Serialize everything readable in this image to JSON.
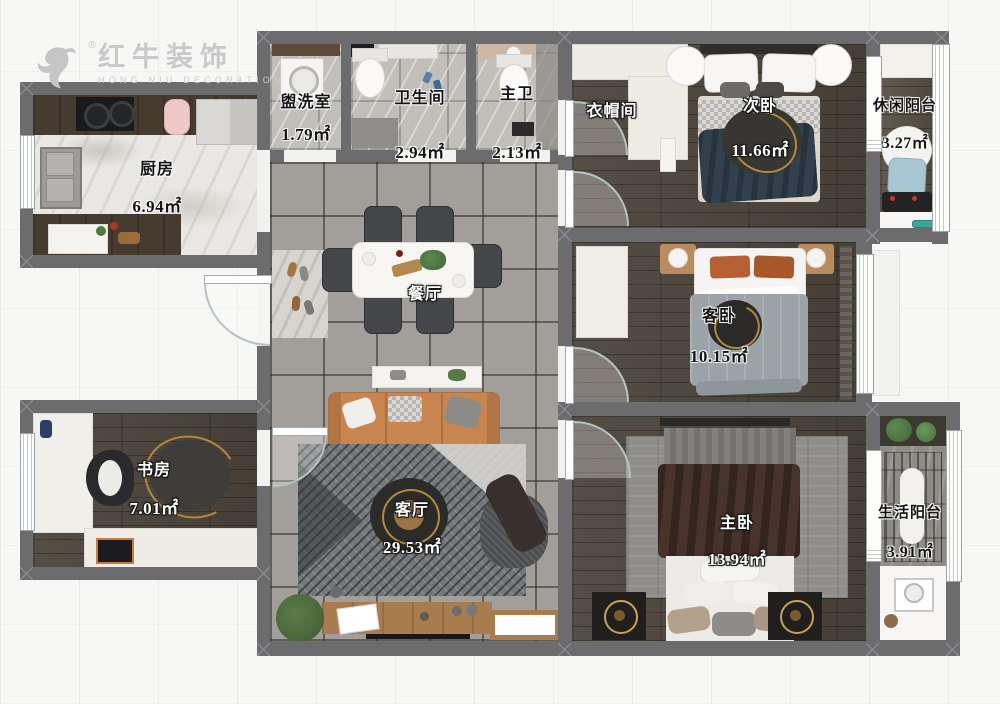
{
  "brand": {
    "name": "红牛装饰",
    "subtitle": "HONG NIU DECORATION",
    "registered": "®",
    "logo_icon": "bull-icon",
    "color": "#c9c9c9"
  },
  "plan": {
    "rooms": {
      "laundry": {
        "name": "盥洗室",
        "area": "1.79㎡"
      },
      "bathroom": {
        "name": "卫生间",
        "area": "2.94㎡"
      },
      "master_bath": {
        "name": "主卫",
        "area": "2.13㎡"
      },
      "cloakroom": {
        "name": "衣帽间",
        "area": ""
      },
      "second_bedroom": {
        "name": "次卧",
        "area": "11.66㎡"
      },
      "leisure_balcony": {
        "name": "休闲阳台",
        "area": "3.27㎡"
      },
      "kitchen": {
        "name": "厨房",
        "area": "6.94㎡"
      },
      "dining": {
        "name": "餐厅",
        "area": ""
      },
      "guest_bedroom": {
        "name": "客卧",
        "area": "10.15㎡"
      },
      "study": {
        "name": "书房",
        "area": "7.01㎡"
      },
      "living": {
        "name": "客厅",
        "area": "29.53㎡"
      },
      "master_bedroom": {
        "name": "主卧",
        "area": "13.94㎡"
      },
      "life_balcony": {
        "name": "生活阳台",
        "area": "3.91㎡"
      }
    },
    "colors": {
      "wall": "#6c6c6f",
      "tile_floor": "#a29f9b",
      "wood_floor": "#4c443a",
      "sofa_accent": "#c9854f",
      "label_light": "#ffffff",
      "label_dark": "#141414"
    }
  }
}
